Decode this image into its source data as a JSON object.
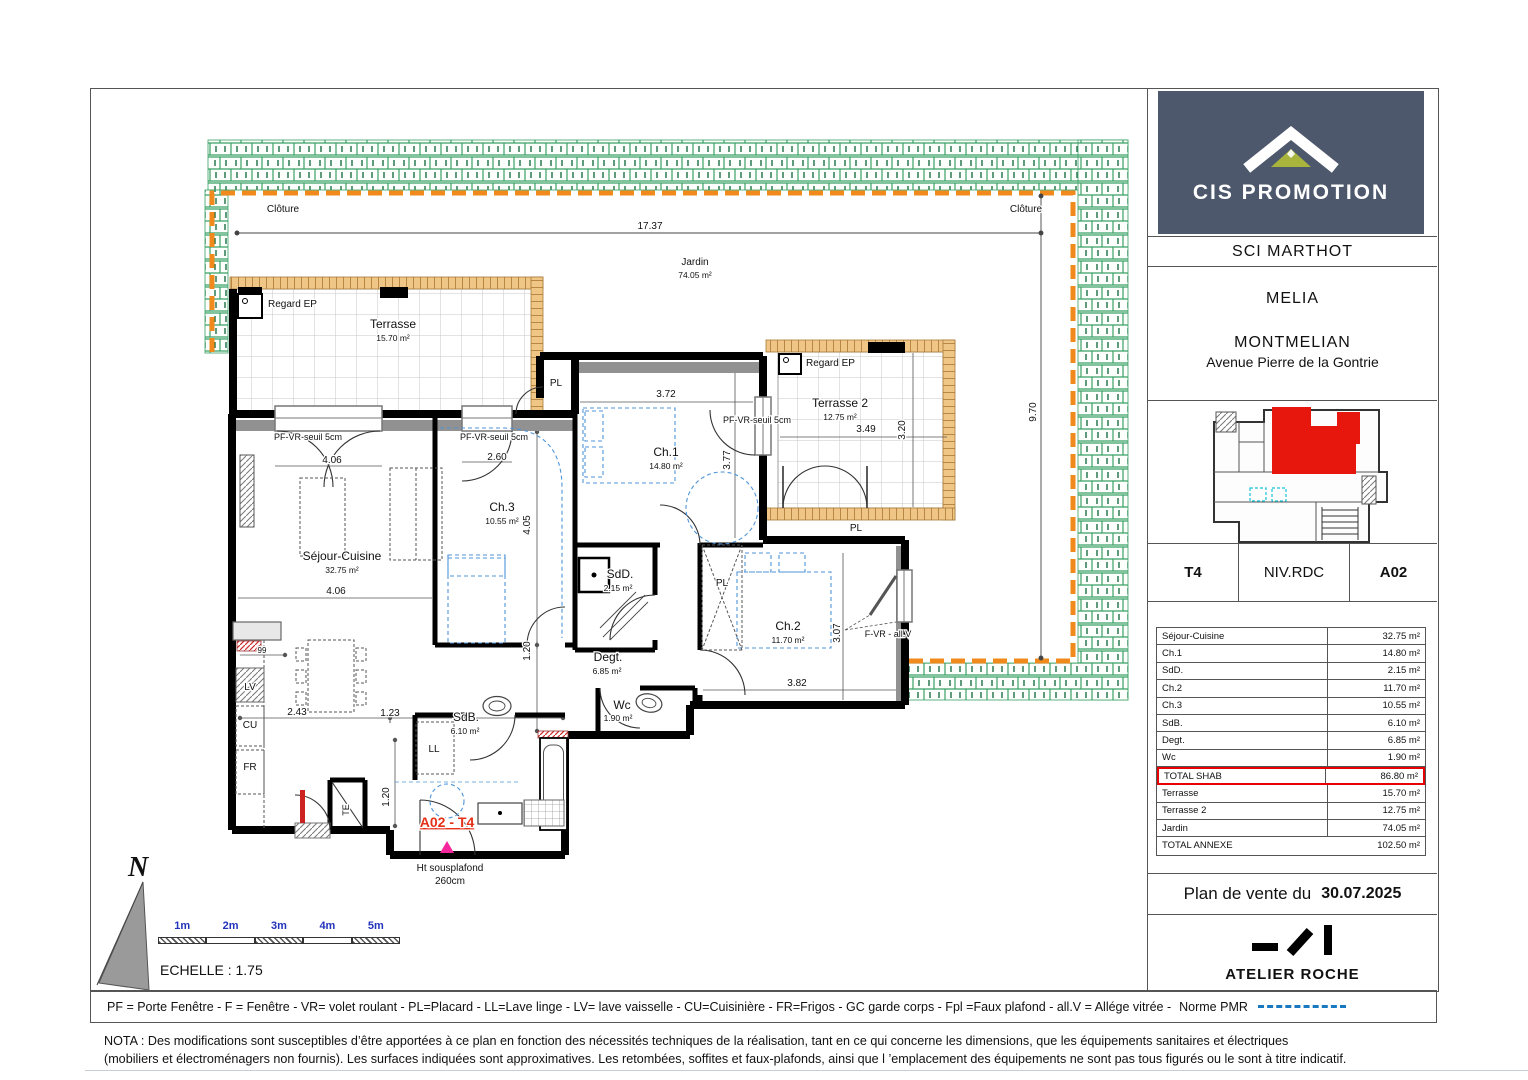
{
  "header": {
    "company": "CIS PROMOTION",
    "client": "SCI MARTHOT",
    "program": "MELIA",
    "city": "MONTMELIAN",
    "address": "Avenue Pierre de la Gontrie"
  },
  "unit": {
    "type": "T4",
    "level": "NIV.RDC",
    "number": "A02"
  },
  "areas": {
    "rows": [
      {
        "label": "Séjour-Cuisine",
        "value": "32.75 m²"
      },
      {
        "label": "Ch.1",
        "value": "14.80 m²"
      },
      {
        "label": "SdD.",
        "value": "2.15 m²"
      },
      {
        "label": "Ch.2",
        "value": "11.70 m²"
      },
      {
        "label": "Ch.3",
        "value": "10.55 m²"
      },
      {
        "label": "SdB.",
        "value": "6.10 m²"
      },
      {
        "label": "Degt.",
        "value": "6.85 m²"
      },
      {
        "label": "Wc",
        "value": "1.90 m²"
      },
      {
        "label": "TOTAL SHAB",
        "value": "86.80 m²",
        "hl": true
      },
      {
        "label": "Terrasse",
        "value": "15.70 m²"
      },
      {
        "label": "Terrasse 2",
        "value": "12.75 m²"
      },
      {
        "label": "Jardin",
        "value": "74.05 m²"
      },
      {
        "label": "TOTAL ANNEXE",
        "value": "102.50 m²",
        "nodiv": true
      }
    ]
  },
  "sale": {
    "title": "Plan de vente du",
    "date": "30.07.2025"
  },
  "architect": {
    "name": "ATELIER ROCHE"
  },
  "legend": {
    "text": "PF = Porte Fenêtre - F = Fenêtre - VR= volet roulant - PL=Placard - LL=Lave linge - LV= lave vaisselle - CU=Cuisinière - FR=Frigos - GC garde corps - Fpl =Faux plafond - all.V = Allége vitrée  -",
    "pmr": "Norme PMR"
  },
  "nota": {
    "line1": "NOTA : Des modifications sont susceptibles d’être apportées à ce plan en fonction des nécessités techniques de la réalisation, tant en ce qui concerne les dimensions, que les équipements sanitaires et électriques",
    "line2": "(mobiliers et électroménagers non fournis). Les surfaces indiquées sont approximatives. Les retombées, soffites et faux-plafonds, ainsi que l ’emplacement des équipements ne sont pas tous figurés ou le sont à titre indicatif."
  },
  "scalebar": {
    "labels": [
      "1m",
      "2m",
      "3m",
      "4m",
      "5m"
    ],
    "echelle": "ECHELLE : 1.75",
    "north": "N"
  },
  "colors": {
    "accent_orange": "#f08a1d",
    "hedge_green": "#39a065",
    "unit_red": "#e8170d",
    "label_red": "#e53117",
    "pmr_blue": "#1879c0",
    "furniture_blue": "#4f95d8",
    "logo_bg": "#4d586c",
    "logo_olive": "#a8b43c",
    "entry_pink": "#f4269b"
  },
  "plan": {
    "labels": [
      {
        "t": "Clôture",
        "x": 283,
        "y": 212,
        "s": 10
      },
      {
        "t": "Clôture",
        "x": 1026,
        "y": 212,
        "s": 10
      },
      {
        "t": "17.37",
        "x": 650,
        "y": 229,
        "s": 10
      },
      {
        "t": "Jardin",
        "x": 695,
        "y": 265,
        "s": 10
      },
      {
        "t": "74.05 m²",
        "x": 695,
        "y": 278,
        "s": 8.5
      },
      {
        "t": "9.70",
        "x": 1036,
        "y": 412,
        "s": 10,
        "r": -90
      },
      {
        "t": "Regard EP",
        "x": 268,
        "y": 307,
        "s": 10,
        "a": "start"
      },
      {
        "t": "Terrasse",
        "x": 393,
        "y": 328,
        "s": 12
      },
      {
        "t": "15.70 m²",
        "x": 393,
        "y": 341,
        "s": 8.5
      },
      {
        "t": "PL",
        "x": 556,
        "y": 386,
        "s": 10
      },
      {
        "t": "Regard EP",
        "x": 806,
        "y": 366,
        "s": 10,
        "a": "start"
      },
      {
        "t": "Terrasse 2",
        "x": 840,
        "y": 407,
        "s": 12
      },
      {
        "t": "12.75 m²",
        "x": 840,
        "y": 420,
        "s": 8.5
      },
      {
        "t": "3.49",
        "x": 866,
        "y": 432,
        "s": 10
      },
      {
        "t": "3.20",
        "x": 905,
        "y": 430,
        "s": 10,
        "r": -90
      },
      {
        "t": "PF-VR-seuil 5cm",
        "x": 308,
        "y": 440,
        "s": 9
      },
      {
        "t": "4.06",
        "x": 332,
        "y": 463,
        "s": 10
      },
      {
        "t": "PF-VR-seuil 5cm",
        "x": 494,
        "y": 440,
        "s": 9
      },
      {
        "t": "2.60",
        "x": 497,
        "y": 460,
        "s": 10
      },
      {
        "t": "PF-VR-seuil 5cm",
        "x": 757,
        "y": 423,
        "s": 9
      },
      {
        "t": "3.72",
        "x": 666,
        "y": 397,
        "s": 10
      },
      {
        "t": "Ch.1",
        "x": 666,
        "y": 456,
        "s": 12
      },
      {
        "t": "14.80 m²",
        "x": 666,
        "y": 469,
        "s": 8.5
      },
      {
        "t": "3.77",
        "x": 730,
        "y": 460,
        "s": 10,
        "r": -90
      },
      {
        "t": "Séjour-Cuisine",
        "x": 342,
        "y": 560,
        "s": 12
      },
      {
        "t": "32.75 m²",
        "x": 342,
        "y": 573,
        "s": 8.5
      },
      {
        "t": "4.06",
        "x": 336,
        "y": 594,
        "s": 10
      },
      {
        "t": "Ch.3",
        "x": 502,
        "y": 511,
        "s": 12
      },
      {
        "t": "10.55 m²",
        "x": 502,
        "y": 524,
        "s": 8.5
      },
      {
        "t": "4.05",
        "x": 530,
        "y": 525,
        "s": 10,
        "r": -90
      },
      {
        "t": "SdD.",
        "x": 620,
        "y": 578,
        "s": 12
      },
      {
        "t": "2.15 m²",
        "x": 618,
        "y": 591,
        "s": 8.5
      },
      {
        "t": "PL",
        "x": 856,
        "y": 531,
        "s": 10
      },
      {
        "t": "Ch.2",
        "x": 788,
        "y": 630,
        "s": 12
      },
      {
        "t": "11.70 m²",
        "x": 788,
        "y": 643,
        "s": 8.5
      },
      {
        "t": "3.07",
        "x": 840,
        "y": 633,
        "s": 10,
        "r": -90
      },
      {
        "t": "F-VR - all.V",
        "x": 888,
        "y": 637,
        "s": 9
      },
      {
        "t": "1.20",
        "x": 530,
        "y": 651,
        "s": 10,
        "r": -90
      },
      {
        "t": "Degt.",
        "x": 608,
        "y": 661,
        "s": 12
      },
      {
        "t": "6.85 m²",
        "x": 607,
        "y": 674,
        "s": 8.5
      },
      {
        "t": "PL",
        "x": 722,
        "y": 586,
        "s": 10
      },
      {
        "t": "Wc",
        "x": 622,
        "y": 709,
        "s": 12
      },
      {
        "t": "1.90 m²",
        "x": 618,
        "y": 721,
        "s": 8.5
      },
      {
        "t": "3.82",
        "x": 797,
        "y": 686,
        "s": 10
      },
      {
        "t": "99",
        "x": 262,
        "y": 653,
        "s": 8
      },
      {
        "t": "2.43",
        "x": 297,
        "y": 715,
        "s": 10
      },
      {
        "t": "1.23",
        "x": 390,
        "y": 716,
        "s": 10
      },
      {
        "t": "SdB.",
        "x": 466,
        "y": 721,
        "s": 12
      },
      {
        "t": "6.10 m²",
        "x": 465,
        "y": 734,
        "s": 8.5
      },
      {
        "t": "LL",
        "x": 434,
        "y": 752,
        "s": 10
      },
      {
        "t": "LV",
        "x": 250,
        "y": 690,
        "s": 10
      },
      {
        "t": "CU",
        "x": 250,
        "y": 728,
        "s": 10
      },
      {
        "t": "FR",
        "x": 250,
        "y": 770,
        "s": 10
      },
      {
        "t": "TE",
        "x": 349,
        "y": 810,
        "s": 9,
        "r": -90
      },
      {
        "t": "1.20",
        "x": 389,
        "y": 797,
        "s": 10,
        "r": -90
      },
      {
        "t": "A02 - T4",
        "x": 447,
        "y": 827,
        "s": 14,
        "b": true,
        "u": true,
        "c": "#e53117"
      },
      {
        "t": "Ht sousplafond",
        "x": 450,
        "y": 871,
        "s": 10
      },
      {
        "t": "260cm",
        "x": 450,
        "y": 884,
        "s": 10
      }
    ]
  }
}
